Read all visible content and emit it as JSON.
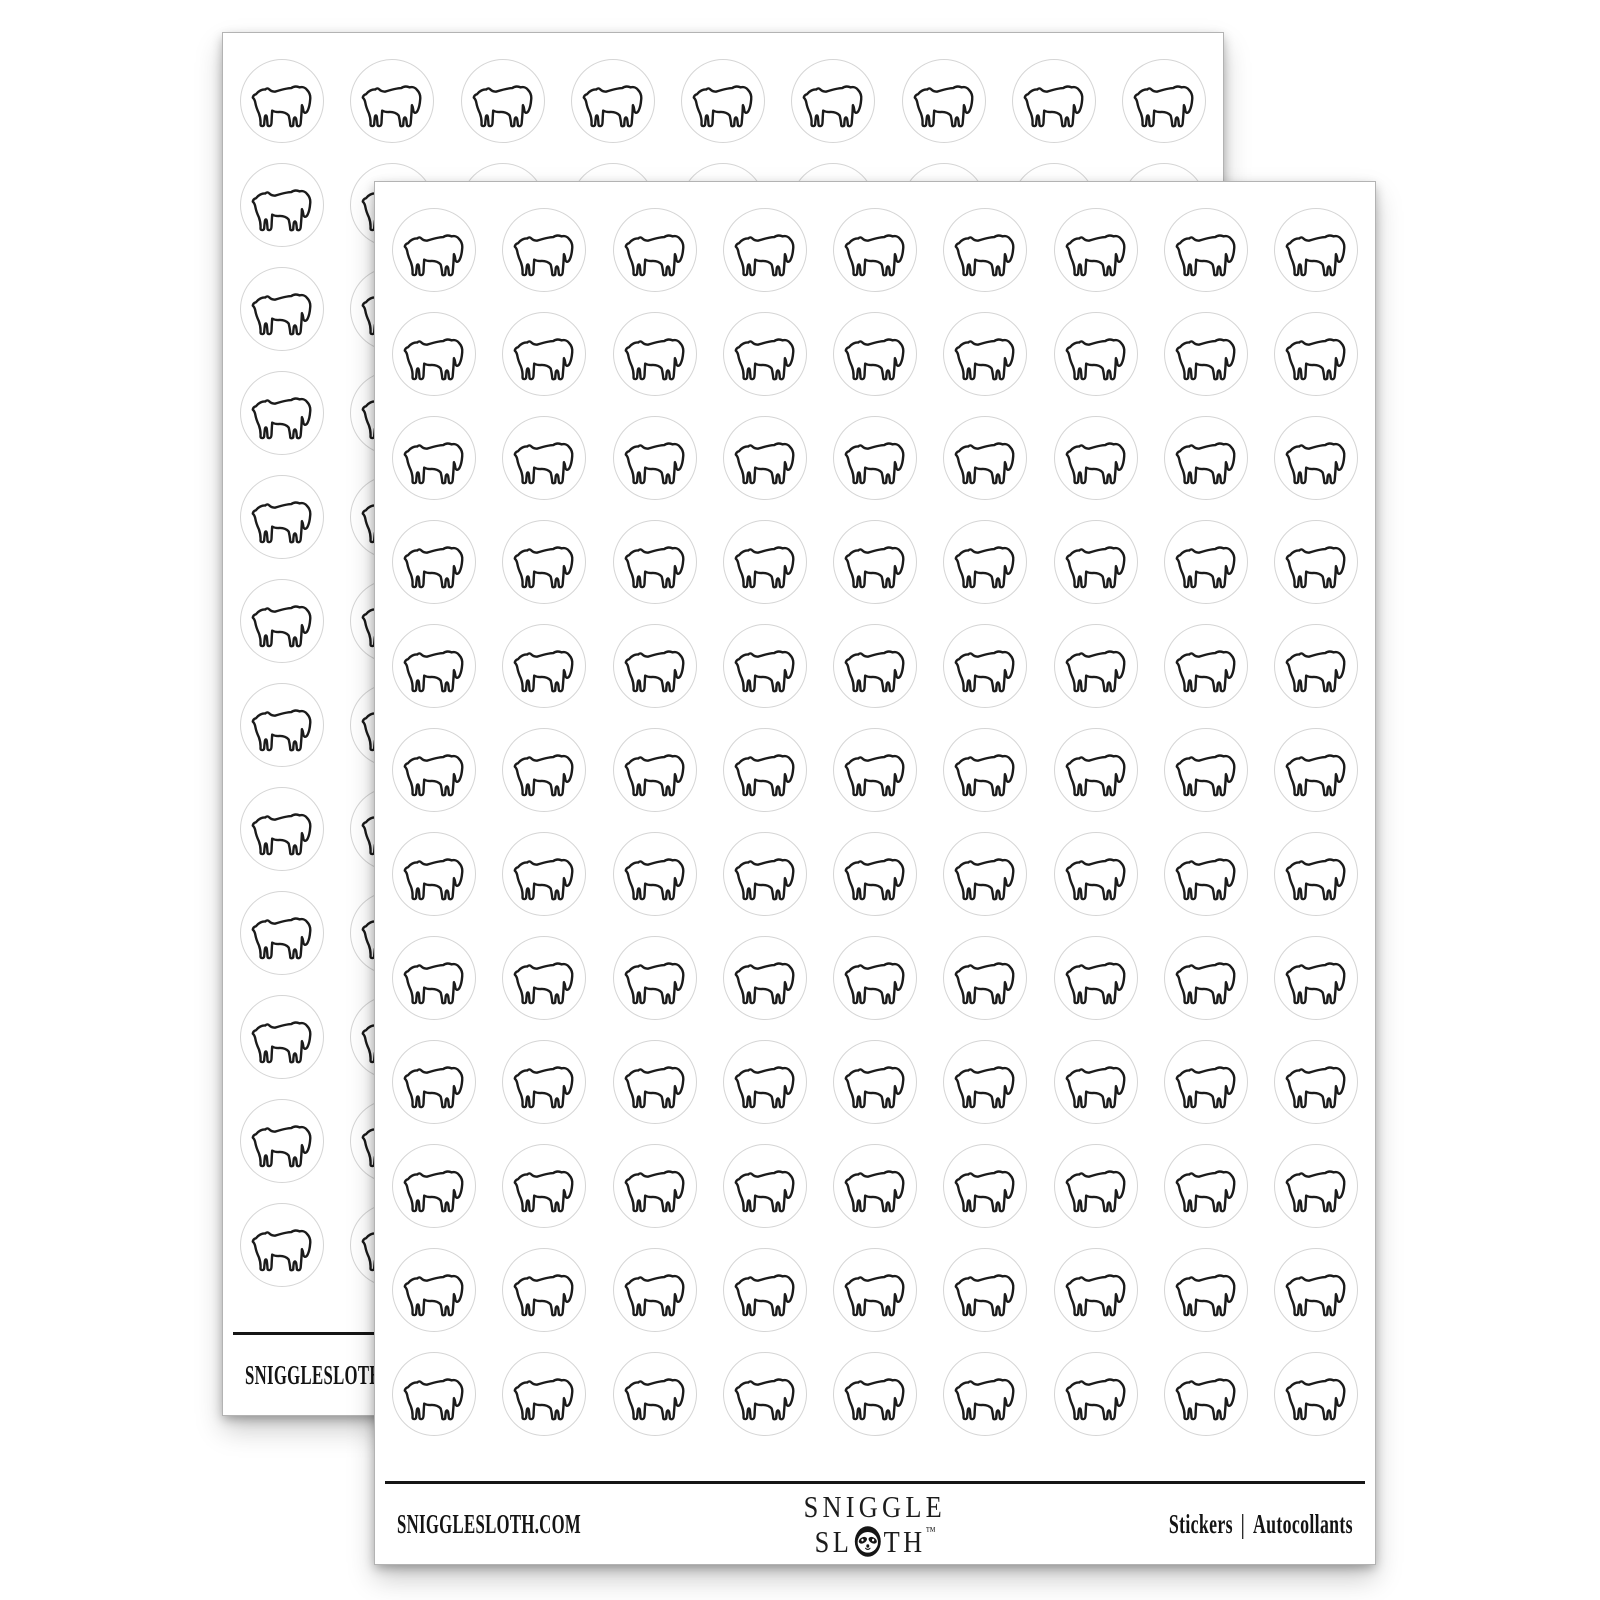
{
  "page": {
    "background_color": "#ffffff"
  },
  "sheet": {
    "rows": 12,
    "cols": 9,
    "sticker": {
      "icon": "great-pyrenees-dog-outline-icon",
      "outline_color": "#1b1b1b",
      "circle_border_color": "#d5d5d5",
      "fill_color": "#ffffff"
    },
    "footer": {
      "website": "SNIGGLESLOTH.COM",
      "brand": {
        "line1": "SNIGGLE",
        "line2_prefix": "SL",
        "line2_suffix": "TH",
        "trademark": "™",
        "sloth_icon": "sloth-face-icon"
      },
      "labels": {
        "en": "Stickers",
        "divider": "|",
        "fr": "Autocollants"
      }
    }
  },
  "scene": {
    "sheet_count": 2
  }
}
